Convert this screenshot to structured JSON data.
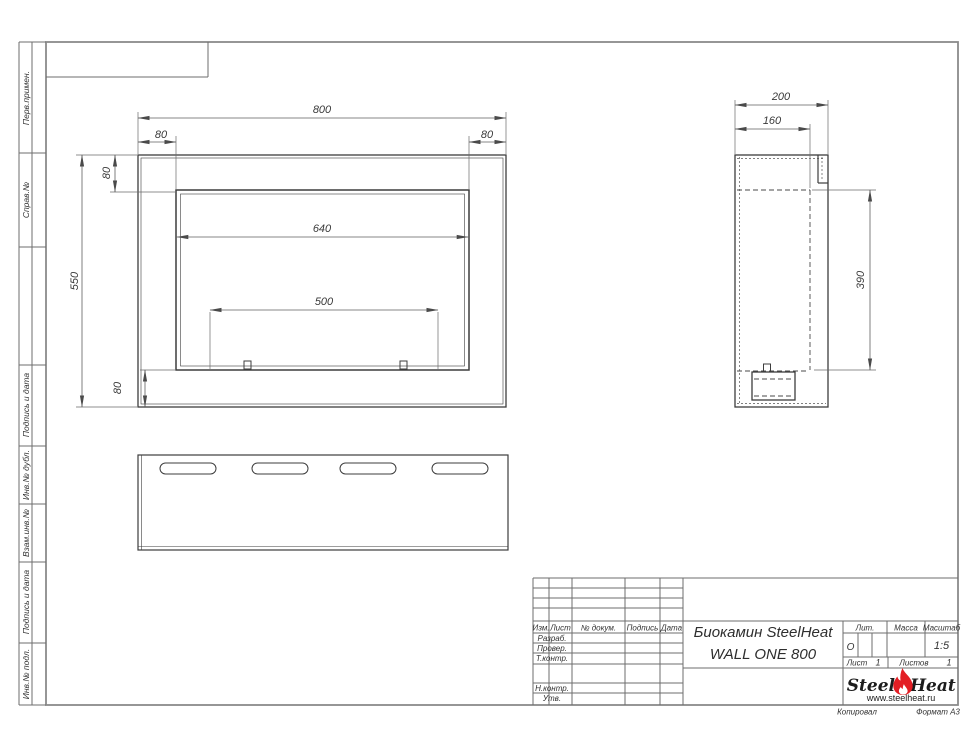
{
  "colors": {
    "object_line": "#3d3d3d",
    "dim_line": "#5f5f5f",
    "frame_line": "#8a8a8a",
    "flame_red": "#e31e24"
  },
  "sidebar": {
    "labels": [
      "Перв.примен.",
      "Справ.№",
      "Подпись и дата",
      "Инв.№ дубл.",
      "Взам.инв.№",
      "Подпись и дата",
      "Инв.№ подл."
    ]
  },
  "dims": {
    "front": {
      "total_width": "800",
      "left_flange": "80",
      "right_flange": "80",
      "top_flange": "80",
      "bottom_flange": "80",
      "total_height": "550",
      "opening_width": "640",
      "burner_width": "500"
    },
    "side": {
      "depth": "200",
      "inner_depth": "160",
      "opening_height": "390"
    }
  },
  "title_block": {
    "revision_header": {
      "izm": "Изм.",
      "list": "Лист",
      "doc": "№ докум.",
      "podpis": "Подпись",
      "data": "Дата"
    },
    "signature_rows": [
      "Разраб.",
      "Провер.",
      "Т.контр.",
      "Н.контр.",
      "Утв."
    ],
    "product_title_line1": "Биокамин SteelHeat",
    "product_title_line2": "WALL ONE 800",
    "lit": {
      "label": "Лит.",
      "value": "О"
    },
    "massa": {
      "label": "Масса"
    },
    "scale": {
      "label": "Масштаб",
      "value": "1:5"
    },
    "sheet_no": {
      "label": "Лист",
      "value": "1"
    },
    "sheets_total": {
      "label": "Листов",
      "value": "1"
    },
    "logo": {
      "steel": "Steel",
      "heat": "Heat",
      "website": "www.steelheat.ru"
    },
    "footer": {
      "copied": "Копировал",
      "format": "Формат А3"
    }
  }
}
